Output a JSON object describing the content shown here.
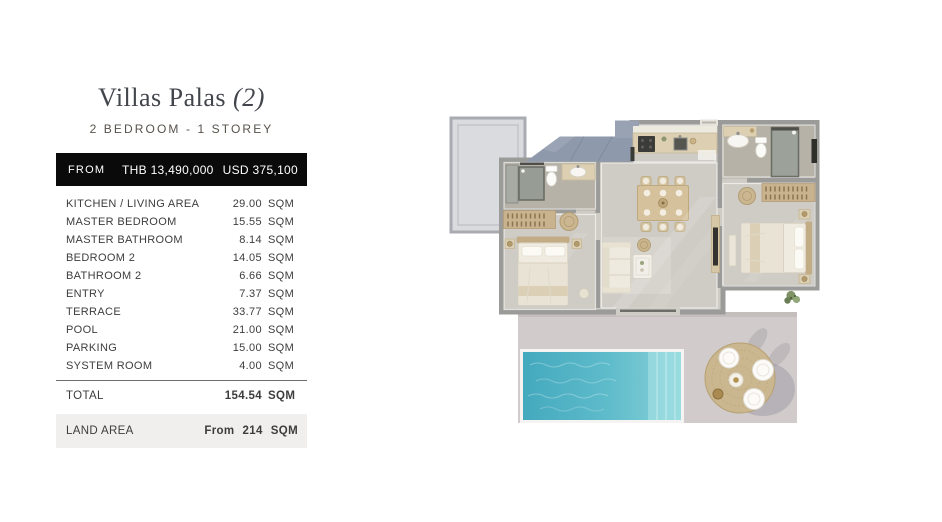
{
  "colors": {
    "price_bar_bg": "#0a0a0a",
    "land_row_bg": "#f0efee",
    "title_color": "#42454b",
    "text_color": "#3d3d3d"
  },
  "header": {
    "title": "Villas Palas",
    "title_suffix": "(2)",
    "subtitle": "2 BEDROOM - 1 STOREY"
  },
  "price_bar": {
    "label": "FROM",
    "thb": "THB 13,490,000",
    "usd": "USD 375,100"
  },
  "area_table": {
    "rows": [
      {
        "label": "KITCHEN / LIVING AREA",
        "value": "29.00",
        "unit": "SQM"
      },
      {
        "label": "MASTER BEDROOM",
        "value": "15.55",
        "unit": "SQM"
      },
      {
        "label": "MASTER BATHROOM",
        "value": "8.14",
        "unit": "SQM"
      },
      {
        "label": "BEDROOM 2",
        "value": "14.05",
        "unit": "SQM"
      },
      {
        "label": "BATHROOM 2",
        "value": "6.66",
        "unit": "SQM"
      },
      {
        "label": "ENTRY",
        "value": "7.37",
        "unit": "SQM"
      },
      {
        "label": "TERRACE",
        "value": "33.77",
        "unit": "SQM"
      },
      {
        "label": "POOL",
        "value": "21.00",
        "unit": "SQM"
      },
      {
        "label": "PARKING",
        "value": "15.00",
        "unit": "SQM"
      },
      {
        "label": "SYSTEM ROOM",
        "value": "4.00",
        "unit": "SQM"
      }
    ],
    "total": {
      "label": "TOTAL",
      "value": "154.54",
      "unit": "SQM"
    },
    "land": {
      "label": "LAND AREA",
      "prefix": "From",
      "value": "214",
      "unit": "SQM"
    }
  },
  "floorplan": {
    "elements": [
      "parking-pad",
      "roof",
      "master-bathroom",
      "master-bedroom",
      "kitchen",
      "dining-area",
      "living-area",
      "entry-corridor",
      "bathroom-2",
      "bedroom-2",
      "terrace",
      "pool",
      "outdoor-dining-set",
      "plant"
    ],
    "colors": {
      "wall": "#9b9b99",
      "floor": "#cfcbc5",
      "bath_floor": "#b6b2a8",
      "roof": "#8e99ab",
      "roof_light": "#98a2b3",
      "terrace": "#d1cccb",
      "pool_a": "#44a9be",
      "pool_b": "#5fbccb",
      "pool_c": "#8ad2d9",
      "wood": "#c9b38f",
      "pad": "#d9dbdf",
      "pad_border": "#a9abb0"
    }
  }
}
